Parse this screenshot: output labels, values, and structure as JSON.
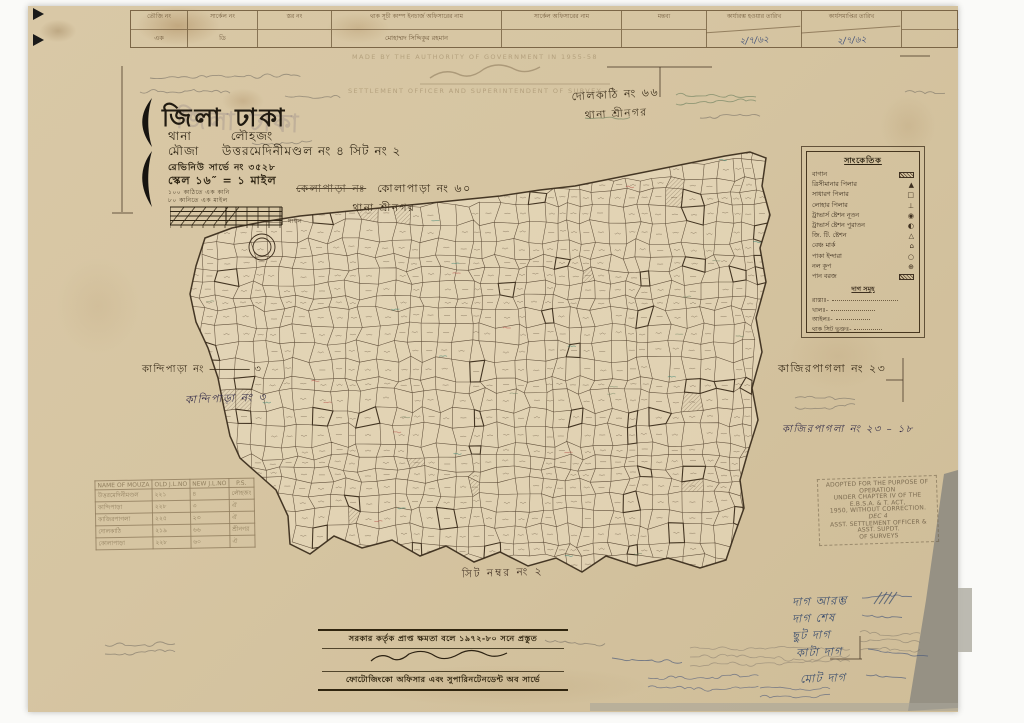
{
  "title_block": {
    "district_label": "জিলা ঢাকা",
    "thana_label": "থানা",
    "thana_value": "লৌহজং",
    "mouza_label": "মৌজা",
    "mouza_value": "উত্তরমেদিনীমণ্ডল নং ৪ সিট নং ২",
    "revenue_line": "রেভিনিউ সার্ভে নং ৩৫২৮",
    "scale_line": "স্কেল ১৬″ = ১ মাইল",
    "note1": "১০০ কাঠিতে এক কানি",
    "note2": "৮০ কানিতে এক মাইল",
    "scale_bar_label": "মাইল"
  },
  "header_table": {
    "columns": [
      {
        "header": "তৌজি নং",
        "value": "এক"
      },
      {
        "header": "সার্কেল নং",
        "value": "ডি"
      },
      {
        "header": "স্তর নং",
        "value": ""
      },
      {
        "header": "থাক সূচী কাম্প ইনচার্জ অফিসারের নাম",
        "value": "মোহাম্মদ সিদ্দিকুর রহমান"
      },
      {
        "header": "সার্কেল অফিসারের নাম",
        "value": ""
      },
      {
        "header": "মন্তব্য",
        "value": ""
      },
      {
        "header": "কার্যারম্ভ হওয়ার তারিখ",
        "value": "২/৭/৬২"
      },
      {
        "header": "কার্যসমাপ্তির তারিখ",
        "value": "২/৭/৬২"
      },
      {
        "header": "",
        "value": ""
      }
    ]
  },
  "neighbours": {
    "kolapara_struck": "কেলাপাড়া নঃ",
    "kolapara_main": "কোলাপাড়া নং ৬০",
    "kolapara_sub": "থানা শ্রীনগর",
    "dolkathi_main": "দোলকাঠি নং ৬৬",
    "dolkathi_sub": "থানা শ্রীনগর",
    "kandipara_printed": "কান্দিপাড়া নং",
    "kandipara_printed_no": "৩",
    "kandipara_ink": "কান্দিপাড়া নং ৩",
    "kazirpagla_printed": "কাজিরপাগলা নং ২৩",
    "kazirpagla_ink": "কাজিরপাগলা নং ২৩ – ১৮",
    "sheet": "সিট নম্বর নং ২"
  },
  "legend": {
    "title": "সাংকেতিক",
    "items": [
      {
        "label": "বাগান",
        "symbol": "hatch"
      },
      {
        "label": "ত্রিসীমানার পিলার",
        "symbol": "▲"
      },
      {
        "label": "সাধারণ পিলার",
        "symbol": "□"
      },
      {
        "label": "লোহার পিলার",
        "symbol": "⊥"
      },
      {
        "label": "ট্রাভার্স ষ্টেশন নূতন",
        "symbol": "◉"
      },
      {
        "label": "ট্রাভার্স ষ্টেশন পুরাতন",
        "symbol": "◐"
      },
      {
        "label": "জি. টি. ষ্টেশন",
        "symbol": "△"
      },
      {
        "label": "বেঞ্চ মার্ক",
        "symbol": "⌂"
      },
      {
        "label": "পাকা ইন্দারা",
        "symbol": "○"
      },
      {
        "label": "নল কূপ",
        "symbol": "⊕"
      },
      {
        "label": "পান বরজ",
        "symbol": "hatch"
      }
    ],
    "section_title": "দাগ সমূহ",
    "lines": [
      "রাস্তাঃ-",
      "খালঃ-",
      "আইলঃ-",
      "থাক সিট ভুক্তঃ-"
    ]
  },
  "stamp": {
    "l1": "ADOPTED FOR THE PURPOSE OF OPERATION",
    "l2": "UNDER CHAPTER IV OF THE E.B.S.A. & T. ACT,",
    "l3": "1950, WITHOUT CORRECTION.",
    "l4": "DEC 4",
    "l5": "ASST. SETTLEMENT OFFICER & ASST. SUPDT.",
    "l6": "OF SURVEYS"
  },
  "mouza_table": {
    "headers": [
      "NAME OF MOUZA",
      "OLD J.L.NO",
      "NEW J.L.NO",
      "P.S."
    ],
    "rows": [
      [
        "উত্তরমেদিনীমণ্ডল",
        "২২১",
        "৪",
        "লৌহজং"
      ],
      [
        "কান্দিপাড়া",
        "২২৮",
        "৩",
        "ঐ"
      ],
      [
        "কাজিরপাগলা",
        "২২৫",
        "২৩",
        "ঐ"
      ],
      [
        "দোলকাঠি",
        "২১৯",
        "৬৬",
        "শ্রীনগর"
      ],
      [
        "কোলাপাড়া",
        "২২৮",
        "৬০",
        "ঐ"
      ]
    ]
  },
  "imprint": {
    "line1": "সরকার কর্তৃক প্রাপ্ত ক্ষমতা বলে ১৯৭২-৮০ সনে প্রস্তুত",
    "line2": "ফোটোজিংকো অফিসার এবং সুপারিনটেনডেন্ট অব সার্ভে"
  },
  "authority": {
    "line1": "MADE BY THE AUTHORITY OF GOVERNMENT IN 1955-58",
    "line2": "SETTLEMENT OFFICER AND SUPERINTENDENT OF SURVEY"
  },
  "dag_summary": [
    "দাগ আরম্ভ",
    "দাগ শেষ",
    "ছুট দাগ",
    "কাটা দাগ",
    "মোট দাগ"
  ],
  "colors": {
    "paper": "#d6c49f",
    "ink": "#3c2e1c",
    "pencil": "#7d7468",
    "green_pencil": "#6b7f5e",
    "blue_ink": "#44547a",
    "stamp": "#6e5f46"
  },
  "map": {
    "seed": 42,
    "x0": 186,
    "x1": 772,
    "y0": 148,
    "y1": 576,
    "boundary": [
      205,
      238,
      232,
      228,
      262,
      222,
      300,
      216,
      340,
      212,
      380,
      208,
      420,
      204,
      460,
      200,
      500,
      196,
      540,
      190,
      575,
      186,
      605,
      180,
      635,
      174,
      665,
      168,
      695,
      162,
      725,
      156,
      750,
      152,
      766,
      158,
      762,
      186,
      770,
      215,
      760,
      248,
      766,
      282,
      756,
      318,
      762,
      352,
      752,
      388,
      758,
      420,
      748,
      452,
      740,
      480,
      744,
      508,
      734,
      536,
      726,
      560,
      700,
      568,
      668,
      558,
      636,
      566,
      606,
      556,
      582,
      572,
      556,
      558,
      528,
      566,
      500,
      552,
      474,
      562,
      446,
      546,
      420,
      556,
      392,
      540,
      362,
      548,
      334,
      536,
      310,
      554,
      290,
      544,
      288,
      516,
      276,
      490,
      258,
      474,
      240,
      458,
      230,
      436,
      224,
      408,
      218,
      378,
      208,
      348,
      196,
      322,
      190,
      294,
      196,
      266
    ]
  }
}
